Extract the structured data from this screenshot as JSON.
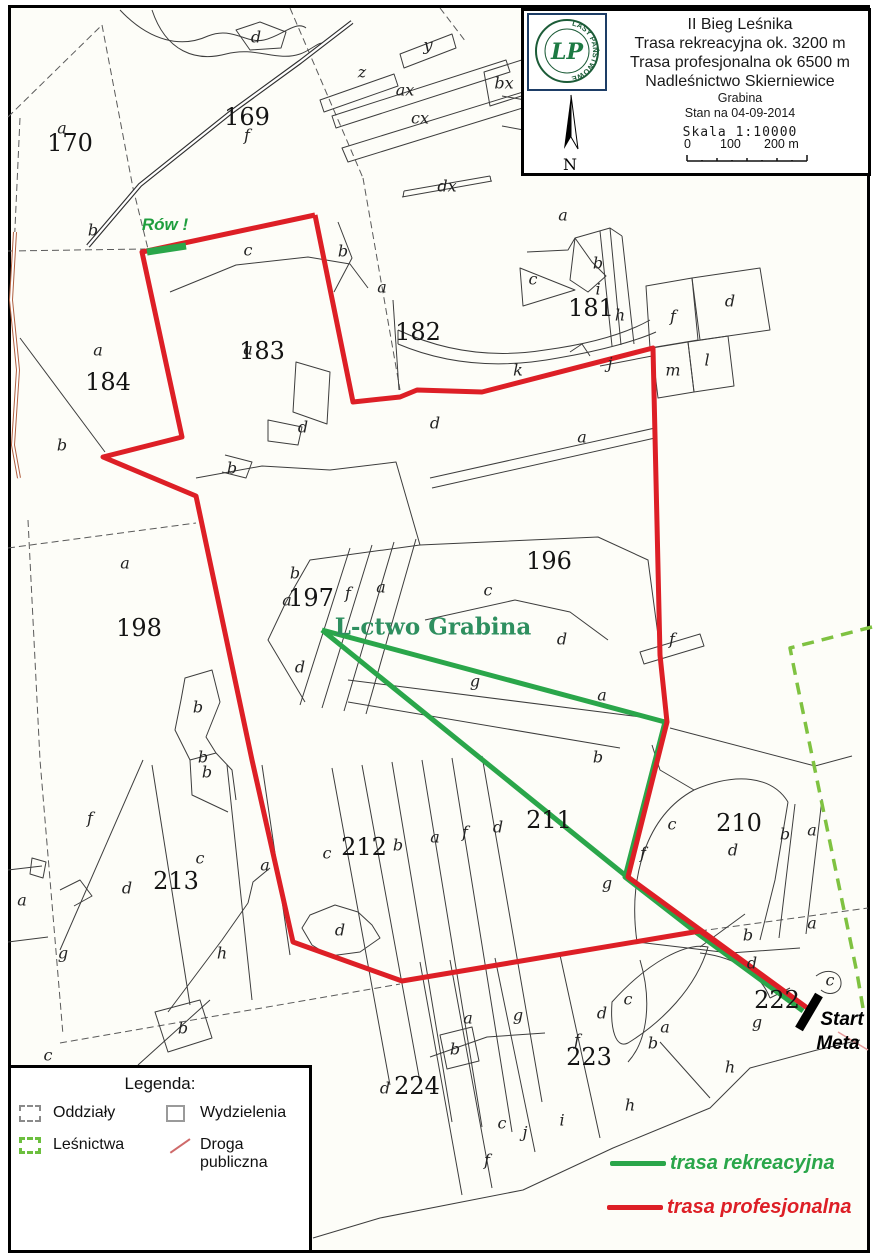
{
  "title_box": {
    "logo_ring_text": "LASY PAŃSTWOWE",
    "logo_letters": "LP",
    "lines": [
      "II Bieg Leśnika",
      "Trasa rekreacyjna ok. 3200 m",
      "Trasa profesjonalna ok 6500 m",
      "Nadleśnictwo Skierniewice"
    ],
    "sublines": [
      "Grabina",
      "Stan na 04-09-2014"
    ],
    "scale_label": "Skala 1:10000",
    "scale_ticks": [
      "0",
      "100",
      "200 m"
    ],
    "compass_letter": "N"
  },
  "legend": {
    "title": "Legenda:",
    "items": [
      {
        "label": "Oddziały",
        "icon": "ic-odd",
        "icon_name": "dashed-gray-square-icon"
      },
      {
        "label": "Wydzielenia",
        "icon": "ic-wyd",
        "icon_name": "gray-square-icon"
      },
      {
        "label": "Leśnictwa",
        "icon": "ic-les",
        "icon_name": "dashed-green-square-icon"
      },
      {
        "label": "Droga publiczna",
        "icon": "ic-drg",
        "icon_name": "red-road-line-icon"
      }
    ]
  },
  "trail_legend": [
    {
      "label": "trasa rekreacyjna",
      "color": "#2aa64a",
      "x": 610,
      "y": 1152
    },
    {
      "label": "trasa profesjonalna",
      "color": "#dd1f26",
      "x": 607,
      "y": 1196
    }
  ],
  "colors": {
    "professional": "#dd1f26",
    "recreational": "#2aa64a",
    "lesnictwo_boundary": "#7fc241",
    "public_road": "#b06040",
    "annotation_green": "#1f9e3e",
    "lctwo_green": "#2e8f5f"
  },
  "annotations": [
    {
      "t": "Rów !",
      "x": 165,
      "y": 225,
      "c": "rov"
    },
    {
      "t": "L-ctwo Grabina",
      "x": 433,
      "y": 627,
      "c": "lctwo"
    },
    {
      "t": "Start",
      "x": 842,
      "y": 1020,
      "c": "startmeta"
    },
    {
      "t": "Meta",
      "x": 838,
      "y": 1044,
      "c": "startmeta"
    }
  ],
  "map_labels": [
    {
      "t": "170",
      "x": 70,
      "y": 143,
      "c": "n"
    },
    {
      "t": "169",
      "x": 247,
      "y": 117,
      "c": "n"
    },
    {
      "t": "182",
      "x": 418,
      "y": 332,
      "c": "n"
    },
    {
      "t": "183",
      "x": 262,
      "y": 351,
      "c": "n"
    },
    {
      "t": "184",
      "x": 108,
      "y": 382,
      "c": "n"
    },
    {
      "t": "181",
      "x": 591,
      "y": 308,
      "c": "n"
    },
    {
      "t": "196",
      "x": 549,
      "y": 561,
      "c": "n"
    },
    {
      "t": "197",
      "x": 311,
      "y": 598,
      "c": "n"
    },
    {
      "t": "198",
      "x": 139,
      "y": 628,
      "c": "n"
    },
    {
      "t": "210",
      "x": 739,
      "y": 823,
      "c": "n"
    },
    {
      "t": "211",
      "x": 549,
      "y": 820,
      "c": "n"
    },
    {
      "t": "212",
      "x": 364,
      "y": 847,
      "c": "n"
    },
    {
      "t": "213",
      "x": 176,
      "y": 881,
      "c": "n"
    },
    {
      "t": "222",
      "x": 777,
      "y": 1000,
      "c": "n"
    },
    {
      "t": "223",
      "x": 589,
      "y": 1057,
      "c": "n"
    },
    {
      "t": "224",
      "x": 417,
      "y": 1086,
      "c": "n"
    },
    {
      "t": "a",
      "x": 62,
      "y": 128,
      "c": "l"
    },
    {
      "t": "f",
      "x": 247,
      "y": 135,
      "c": "l"
    },
    {
      "t": "d",
      "x": 256,
      "y": 37,
      "c": "l"
    },
    {
      "t": "b",
      "x": 93,
      "y": 230,
      "c": "l"
    },
    {
      "t": "z",
      "x": 362,
      "y": 72,
      "c": "l"
    },
    {
      "t": "y",
      "x": 428,
      "y": 45,
      "c": "l"
    },
    {
      "t": "ax",
      "x": 405,
      "y": 90,
      "c": "l"
    },
    {
      "t": "bx",
      "x": 504,
      "y": 83,
      "c": "l"
    },
    {
      "t": "cx",
      "x": 420,
      "y": 118,
      "c": "l"
    },
    {
      "t": "dx",
      "x": 447,
      "y": 186,
      "c": "l"
    },
    {
      "t": "c",
      "x": 248,
      "y": 250,
      "c": "l"
    },
    {
      "t": "b",
      "x": 343,
      "y": 251,
      "c": "l"
    },
    {
      "t": "a",
      "x": 382,
      "y": 287,
      "c": "l"
    },
    {
      "t": "a",
      "x": 560,
      "y": 97,
      "c": "l"
    },
    {
      "t": "a",
      "x": 563,
      "y": 215,
      "c": "l"
    },
    {
      "t": "b",
      "x": 598,
      "y": 263,
      "c": "l"
    },
    {
      "t": "c",
      "x": 533,
      "y": 279,
      "c": "l"
    },
    {
      "t": "i",
      "x": 598,
      "y": 289,
      "c": "l"
    },
    {
      "t": "h",
      "x": 620,
      "y": 315,
      "c": "l"
    },
    {
      "t": "f",
      "x": 673,
      "y": 316,
      "c": "l"
    },
    {
      "t": "d",
      "x": 730,
      "y": 301,
      "c": "l"
    },
    {
      "t": "j",
      "x": 610,
      "y": 363,
      "c": "l"
    },
    {
      "t": "m",
      "x": 673,
      "y": 370,
      "c": "l"
    },
    {
      "t": "l",
      "x": 707,
      "y": 360,
      "c": "l"
    },
    {
      "t": "a",
      "x": 582,
      "y": 437,
      "c": "l"
    },
    {
      "t": "k",
      "x": 518,
      "y": 370,
      "c": "l"
    },
    {
      "t": "d",
      "x": 435,
      "y": 423,
      "c": "l"
    },
    {
      "t": "d",
      "x": 303,
      "y": 427,
      "c": "l"
    },
    {
      "t": "b",
      "x": 232,
      "y": 468,
      "c": "l"
    },
    {
      "t": "a",
      "x": 98,
      "y": 350,
      "c": "l"
    },
    {
      "t": "a",
      "x": 248,
      "y": 349,
      "c": "l"
    },
    {
      "t": "b",
      "x": 62,
      "y": 445,
      "c": "l"
    },
    {
      "t": "a",
      "x": 125,
      "y": 563,
      "c": "l"
    },
    {
      "t": "b",
      "x": 198,
      "y": 707,
      "c": "l"
    },
    {
      "t": "b",
      "x": 203,
      "y": 757,
      "c": "l"
    },
    {
      "t": "b",
      "x": 295,
      "y": 573,
      "c": "l"
    },
    {
      "t": "a",
      "x": 287,
      "y": 600,
      "c": "l"
    },
    {
      "t": "f",
      "x": 348,
      "y": 593,
      "c": "l"
    },
    {
      "t": "a",
      "x": 381,
      "y": 587,
      "c": "l"
    },
    {
      "t": "c",
      "x": 488,
      "y": 590,
      "c": "l"
    },
    {
      "t": "d",
      "x": 562,
      "y": 639,
      "c": "l"
    },
    {
      "t": "d",
      "x": 300,
      "y": 667,
      "c": "l"
    },
    {
      "t": "g",
      "x": 475,
      "y": 681,
      "c": "l"
    },
    {
      "t": "a",
      "x": 602,
      "y": 695,
      "c": "l"
    },
    {
      "t": "b",
      "x": 598,
      "y": 757,
      "c": "l"
    },
    {
      "t": "f",
      "x": 672,
      "y": 639,
      "c": "l"
    },
    {
      "t": "a",
      "x": 22,
      "y": 900,
      "c": "l"
    },
    {
      "t": "f",
      "x": 90,
      "y": 818,
      "c": "l"
    },
    {
      "t": "d",
      "x": 127,
      "y": 888,
      "c": "l"
    },
    {
      "t": "c",
      "x": 200,
      "y": 858,
      "c": "l"
    },
    {
      "t": "a",
      "x": 265,
      "y": 865,
      "c": "l"
    },
    {
      "t": "g",
      "x": 63,
      "y": 953,
      "c": "l"
    },
    {
      "t": "h",
      "x": 222,
      "y": 953,
      "c": "l"
    },
    {
      "t": "b",
      "x": 207,
      "y": 772,
      "c": "l"
    },
    {
      "t": "b",
      "x": 183,
      "y": 1028,
      "c": "l"
    },
    {
      "t": "c",
      "x": 48,
      "y": 1055,
      "c": "l"
    },
    {
      "t": "c",
      "x": 327,
      "y": 853,
      "c": "l"
    },
    {
      "t": "b",
      "x": 398,
      "y": 845,
      "c": "l"
    },
    {
      "t": "a",
      "x": 435,
      "y": 837,
      "c": "l"
    },
    {
      "t": "f",
      "x": 465,
      "y": 832,
      "c": "l"
    },
    {
      "t": "d",
      "x": 498,
      "y": 827,
      "c": "l"
    },
    {
      "t": "d",
      "x": 340,
      "y": 930,
      "c": "l"
    },
    {
      "t": "c",
      "x": 672,
      "y": 824,
      "c": "l"
    },
    {
      "t": "d",
      "x": 733,
      "y": 850,
      "c": "l"
    },
    {
      "t": "b",
      "x": 785,
      "y": 834,
      "c": "l"
    },
    {
      "t": "a",
      "x": 812,
      "y": 830,
      "c": "l"
    },
    {
      "t": "f",
      "x": 643,
      "y": 853,
      "c": "l"
    },
    {
      "t": "g",
      "x": 607,
      "y": 883,
      "c": "l"
    },
    {
      "t": "b",
      "x": 748,
      "y": 935,
      "c": "l"
    },
    {
      "t": "a",
      "x": 812,
      "y": 923,
      "c": "l"
    },
    {
      "t": "c",
      "x": 830,
      "y": 980,
      "c": "l"
    },
    {
      "t": "a",
      "x": 468,
      "y": 1018,
      "c": "l"
    },
    {
      "t": "g",
      "x": 518,
      "y": 1015,
      "c": "l"
    },
    {
      "t": "d",
      "x": 602,
      "y": 1013,
      "c": "l"
    },
    {
      "t": "c",
      "x": 628,
      "y": 999,
      "c": "l"
    },
    {
      "t": "a",
      "x": 665,
      "y": 1027,
      "c": "l"
    },
    {
      "t": "b",
      "x": 653,
      "y": 1043,
      "c": "l"
    },
    {
      "t": "f",
      "x": 577,
      "y": 1040,
      "c": "l"
    },
    {
      "t": "b",
      "x": 455,
      "y": 1049,
      "c": "l"
    },
    {
      "t": "d",
      "x": 385,
      "y": 1088,
      "c": "l"
    },
    {
      "t": "h",
      "x": 630,
      "y": 1105,
      "c": "l"
    },
    {
      "t": "i",
      "x": 562,
      "y": 1120,
      "c": "l"
    },
    {
      "t": "j",
      "x": 525,
      "y": 1132,
      "c": "l"
    },
    {
      "t": "c",
      "x": 502,
      "y": 1123,
      "c": "l"
    },
    {
      "t": "f",
      "x": 487,
      "y": 1160,
      "c": "l"
    },
    {
      "t": "h",
      "x": 730,
      "y": 1067,
      "c": "l"
    },
    {
      "t": "g",
      "x": 757,
      "y": 1022,
      "c": "l"
    },
    {
      "t": "d",
      "x": 752,
      "y": 963,
      "c": "l"
    }
  ],
  "routes": [
    {
      "name": "road-forest-top",
      "color": "#ffffff",
      "width": 2.2,
      "casing": {
        "color": "#2f2f2f",
        "width": 4.5
      },
      "points": [
        [
          88,
          246
        ],
        [
          140,
          185
        ],
        [
          230,
          113
        ],
        [
          300,
          62
        ],
        [
          352,
          22
        ]
      ]
    },
    {
      "name": "road-public-left",
      "color": "#ffffff",
      "width": 2,
      "casing": {
        "color": "#b06040",
        "width": 4
      },
      "points": [
        [
          15,
          232
        ],
        [
          11,
          300
        ],
        [
          18,
          370
        ],
        [
          13,
          445
        ],
        [
          19,
          478
        ]
      ]
    },
    {
      "name": "road-public-corner",
      "color": "#e59a9a",
      "width": 1.5,
      "points": [
        [
          838,
          1032
        ],
        [
          868,
          1050
        ]
      ]
    },
    {
      "name": "lesnictwo-boundary",
      "color": "#7fc241",
      "width": 3.5,
      "dash": "12 8",
      "points": [
        [
          872,
          627
        ],
        [
          790,
          648
        ],
        [
          797,
          683
        ],
        [
          857,
          973
        ],
        [
          863,
          1008
        ]
      ]
    },
    {
      "name": "trasa-rekreacyjna-lower",
      "color": "#2aa64a",
      "width": 5,
      "points": [
        [
          322,
          630
        ],
        [
          610,
          863
        ],
        [
          697,
          933
        ]
      ]
    },
    {
      "name": "trasa-rekreacyjna-main",
      "color": "#2aa64a",
      "width": 5,
      "points": [
        [
          322,
          630
        ],
        [
          665,
          722
        ],
        [
          625,
          877
        ],
        [
          697,
          933
        ],
        [
          803,
          1011
        ]
      ]
    },
    {
      "name": "trasa-profesjonalna",
      "color": "#dd1f26",
      "width": 5,
      "points": [
        [
          315,
          215
        ],
        [
          142,
          252
        ],
        [
          182,
          437
        ],
        [
          103,
          457
        ],
        [
          196,
          496
        ],
        [
          252,
          760
        ],
        [
          293,
          942
        ],
        [
          402,
          981
        ],
        [
          700,
          931
        ],
        [
          806,
          1007
        ],
        [
          628,
          877
        ],
        [
          667,
          722
        ],
        [
          660,
          655
        ],
        [
          653,
          348
        ],
        [
          482,
          392
        ],
        [
          417,
          390
        ],
        [
          400,
          397
        ],
        [
          353,
          402
        ],
        [
          315,
          215
        ]
      ]
    },
    {
      "name": "row-ditch-mark",
      "color": "#2aa64a",
      "width": 7,
      "points": [
        [
          147,
          252
        ],
        [
          186,
          246
        ]
      ]
    },
    {
      "name": "start-finish-bar",
      "color": "#000000",
      "width": 9,
      "points": [
        [
          799,
          1029
        ],
        [
          819,
          995
        ]
      ]
    }
  ]
}
